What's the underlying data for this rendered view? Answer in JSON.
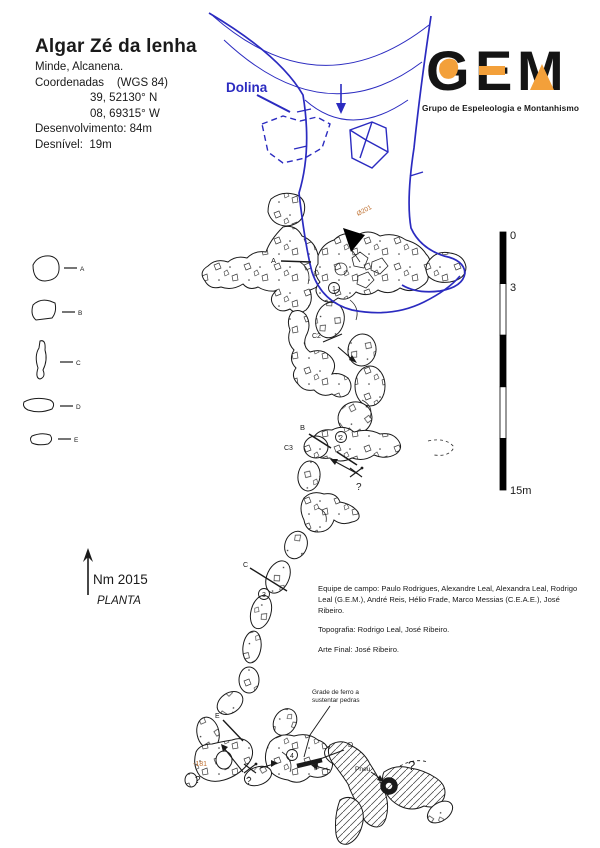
{
  "header": {
    "title": "Algar Zé da lenha",
    "location": "Minde, Alcanena.",
    "coords_label": "Coordenadas    (WGS 84)",
    "lat": "39, 52130° N",
    "lon": "08, 69315° W",
    "development": "Desenvolvimento: 84m",
    "depth": "Desnível:  19m"
  },
  "logo": {
    "g": "G",
    "e": "E",
    "m": "M",
    "subtitle": "Grupo de Espeleologia e Montanhismo"
  },
  "map": {
    "dolina": "Dolina",
    "entrance_code": "Ø201",
    "depth_point": "-181",
    "grate1": "Grade de ferro a",
    "grate2": "sustentar pedras",
    "pneu": "Pneu",
    "q": "?",
    "north_label": "Nm 2015",
    "view_label": "PLANTA",
    "stations": {
      "s1": "1",
      "s2": "2",
      "s3": "3",
      "s4": "4"
    },
    "sections": {
      "a": "A",
      "b": "B",
      "c": "C",
      "c2": "C2",
      "c3": "C3",
      "d": "D",
      "e": "E"
    }
  },
  "scale_bar": {
    "top": "0",
    "second": "3",
    "bottom": "15m"
  },
  "credits": {
    "team": "Equipe de campo: Paulo Rodrigues, Alexandre Leal, Alexandra Leal, Rodrigo Leal (G.E.M.), André Reis, Hélio Frade, Marco Messias (C.E.A.E.), José Ribeiro.",
    "topography": "Topografia: Rodrigo Leal, José Ribeiro.",
    "art": "Arte Final: José Ribeiro."
  },
  "colors": {
    "blue": "#2b2bc0",
    "label_orange": "#bf7030",
    "logo_orange": "#f3a03a",
    "ink": "#1a1a1a"
  }
}
